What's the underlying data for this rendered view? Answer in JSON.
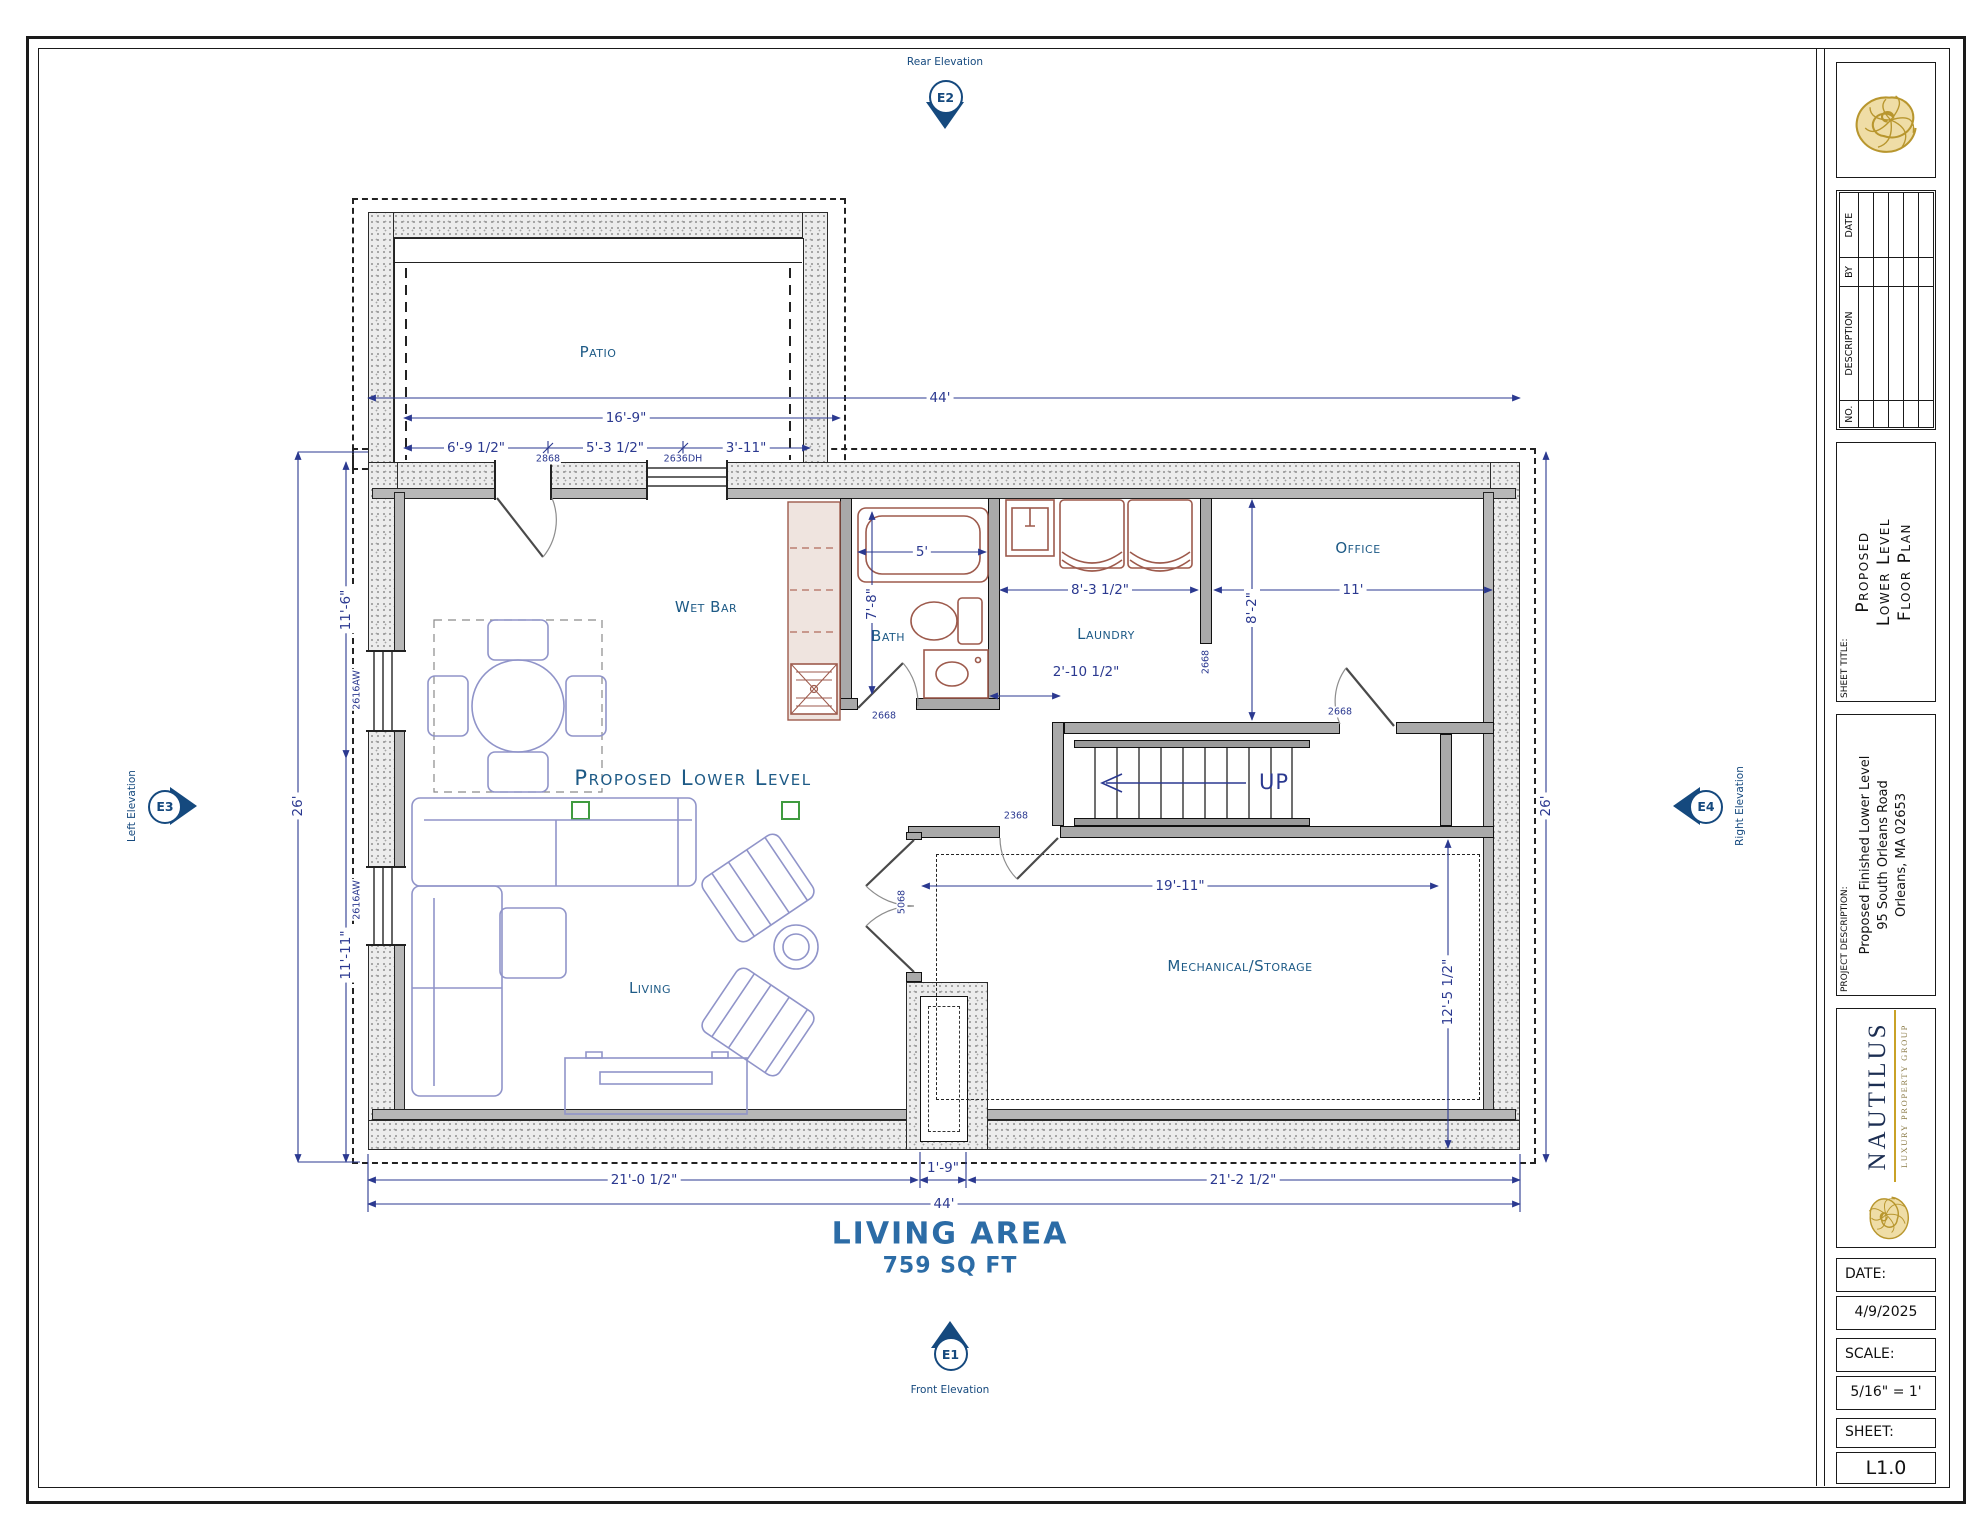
{
  "colors": {
    "accent": "#2b3990",
    "room_label": "#1d5a86",
    "marker": "#15497e",
    "gold": "#c9a227"
  },
  "plan": {
    "title": "Proposed Lower Level",
    "area": {
      "title": "LIVING AREA",
      "value": "759 SQ FT"
    },
    "rooms": {
      "patio": "Patio",
      "wet_bar": "Wet Bar",
      "bath": "Bath",
      "laundry": "Laundry",
      "office": "Office",
      "living": "Living",
      "mechanical": "Mechanical/Storage",
      "stairs_up": "UP"
    },
    "dims": {
      "overall_width_top": "44'",
      "patio_width": "16'-9\"",
      "seg1": "6'-9 1/2\"",
      "seg2": "5'-3 1/2\"",
      "seg3": "3'-11\"",
      "left_depth": "26'",
      "left_upper": "11'-6\"",
      "left_lower": "11'-11\"",
      "right_depth": "26'",
      "tub": "5'",
      "bath_depth": "7'-8\"",
      "laundry_width": "8'-3 1/2\"",
      "office_width": "11'",
      "office_depth": "8'-2\"",
      "hall": "2'-10 1/2\"",
      "mech_width": "19'-11\"",
      "mech_depth": "12'-5 1/2\"",
      "bottom_left": "21'-0 1/2\"",
      "chimney": "1'-9\"",
      "bottom_right": "21'-2 1/2\"",
      "overall_width_bottom": "44'"
    },
    "openings": {
      "door_patio": "2868",
      "window_patio": "2636DH",
      "window_left_upper": "2616AW",
      "window_left_lower": "2616AW",
      "door_bath": "2668",
      "door_hall": "2668",
      "door_office": "2668",
      "door_mech": "2368",
      "door_living": "5068"
    },
    "markers": {
      "e1": {
        "id": "E1",
        "label": "Front Elevation"
      },
      "e2": {
        "id": "E2",
        "label": "Rear Elevation"
      },
      "e3": {
        "id": "E3",
        "label": "Left Elevation"
      },
      "e4": {
        "id": "E4",
        "label": "Right Elevation"
      }
    }
  },
  "title_block": {
    "revisions": {
      "headers": [
        "NO.",
        "DESCRIPTION",
        "BY",
        "DATE"
      ]
    },
    "sheet_title": {
      "label": "SHEET TITLE:",
      "lines": [
        "Proposed",
        "Lower Level",
        "Floor Plan"
      ]
    },
    "project": {
      "label": "PROJECT DESCRIPTION:",
      "lines": [
        "Proposed Finished Lower Level",
        "95 South Orleans Road",
        "Orleans, MA 02653"
      ]
    },
    "brand": {
      "name": "NAUTILUS",
      "tagline": "Luxury Property Group"
    },
    "fields": {
      "date_label": "DATE:",
      "date": "4/9/2025",
      "scale_label": "SCALE:",
      "scale": "5/16\" = 1'",
      "sheet_label": "SHEET:",
      "sheet": "L1.0"
    }
  }
}
